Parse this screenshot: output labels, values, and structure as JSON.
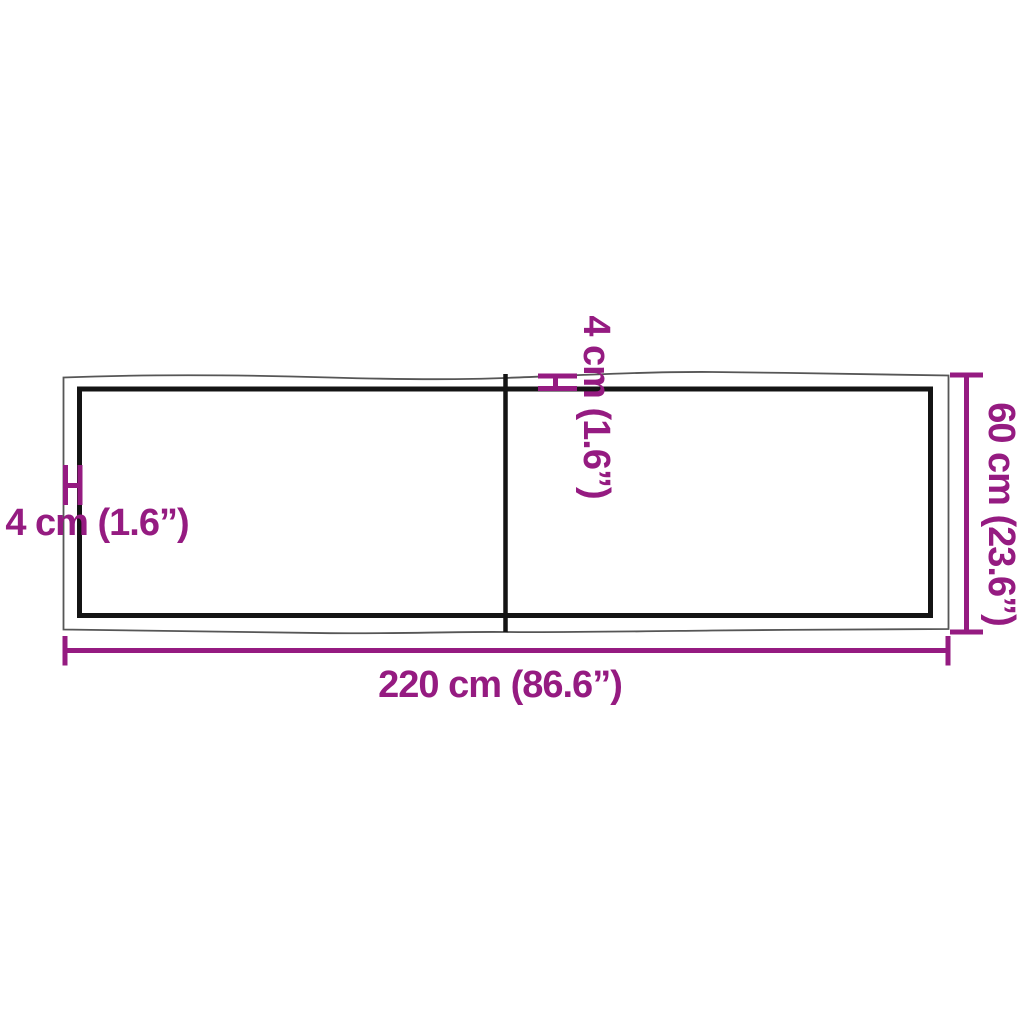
{
  "figure": {
    "labels": {
      "width": "220 cm (86.6”)",
      "depth": "60 cm (23.6”)",
      "thickness_left": "4 cm (1.6”)",
      "thickness_center": "4 cm (1.6”)"
    },
    "colors": {
      "dimension": "#951b81",
      "outer_edge": "#565656",
      "inner_edge": "#141414",
      "background": "#ffffff"
    }
  }
}
